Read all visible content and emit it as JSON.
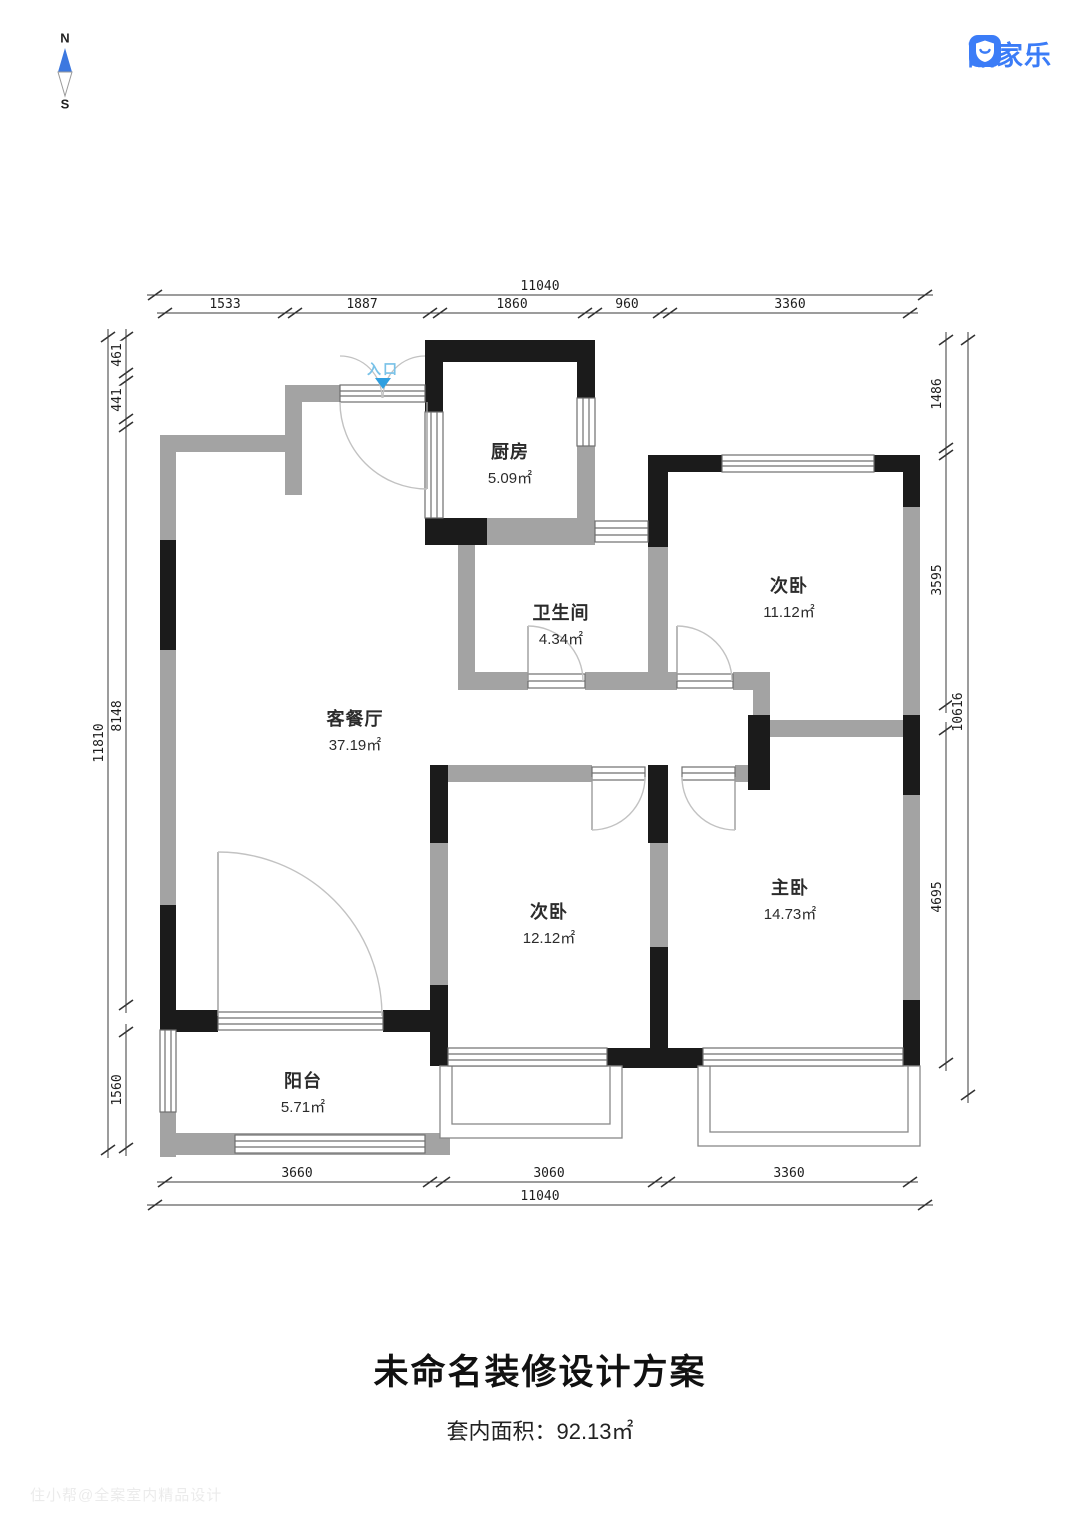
{
  "compass": {
    "north": "N",
    "south": "S"
  },
  "logo": {
    "text": "酷家乐",
    "color": "#3b7cf7"
  },
  "plan": {
    "entrance_label": "入口",
    "rooms": {
      "kitchen": {
        "name": "厨房",
        "area": "5.09㎡"
      },
      "bathroom": {
        "name": "卫生间",
        "area": "4.34㎡"
      },
      "living": {
        "name": "客餐厅",
        "area": "37.19㎡"
      },
      "bedroom_ne": {
        "name": "次卧",
        "area": "11.12㎡"
      },
      "bedroom_s": {
        "name": "次卧",
        "area": "12.12㎡"
      },
      "master": {
        "name": "主卧",
        "area": "14.73㎡"
      },
      "balcony": {
        "name": "阳台",
        "area": "5.71㎡"
      }
    },
    "dims": {
      "top": {
        "total": "11040",
        "segs": [
          "1533",
          "1887",
          "1860",
          "960",
          "3360"
        ]
      },
      "bottom": {
        "total": "11040",
        "segs": [
          "3660",
          "3060",
          "3360"
        ]
      },
      "left": {
        "total": "11810",
        "segs": [
          "461",
          "441",
          "8148",
          "1560"
        ]
      },
      "right": {
        "total": "10616",
        "segs": [
          "1486",
          "3595",
          "4695"
        ]
      }
    }
  },
  "footer": {
    "title": "未命名装修设计方案",
    "subtitle": "套内面积：92.13㎡"
  },
  "watermark": "住小帮@全案室内精品设计"
}
